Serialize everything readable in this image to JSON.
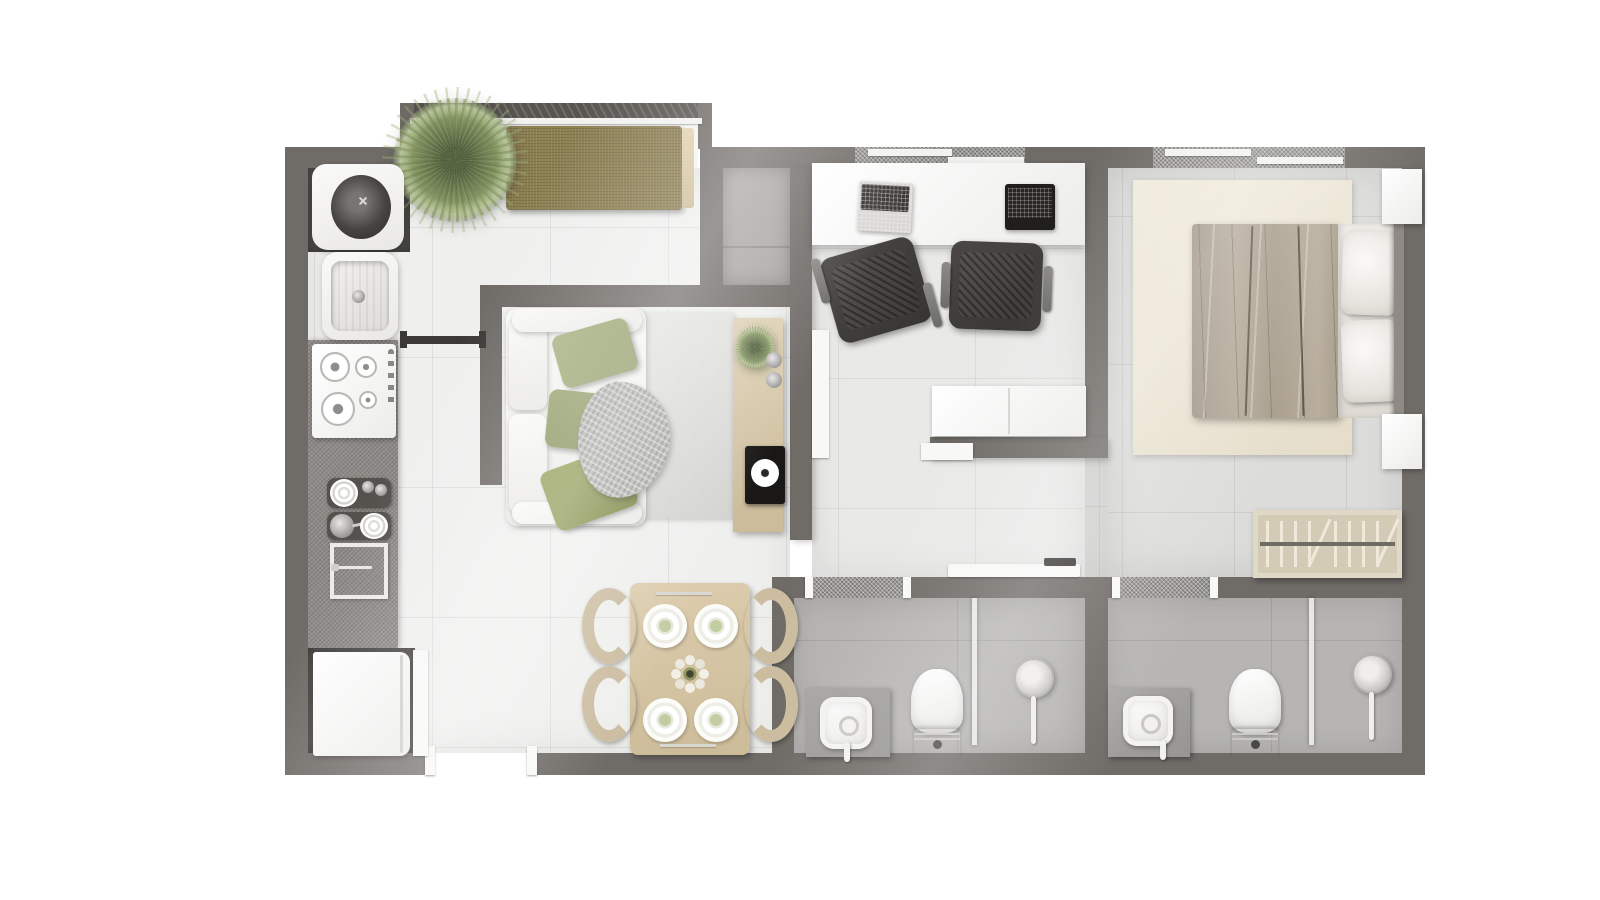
{
  "meta": {
    "title": "Apartment floor plan — top-down 3D render",
    "canvas_width": 1600,
    "canvas_height": 900,
    "visible_text": "none"
  },
  "palette": {
    "wall": "#6f6b67",
    "wall2": "#585450",
    "glassband": "#9b9995",
    "floor1": "#eff0ee",
    "floor2": "#e9eae8",
    "floor3": "#dcdcda",
    "floor4": "#b6b5b3",
    "niche": "#545150",
    "counter": "#8e8b88",
    "olive": "#8c7f51",
    "beige": "#ccbda1",
    "throw": "#b9b8b5"
  },
  "rooms": {
    "balcony": {
      "label": "Balcony bay",
      "items": {
        "bench": "Olive bench seat",
        "plant": "Large potted plant",
        "railing": "Balcony railing"
      }
    },
    "kitchen": {
      "label": "Kitchen",
      "items": {
        "washer": "Washing machine",
        "sink": "Kitchen sink",
        "cooktop": "Gas cooktop",
        "counter": "Countertop",
        "dishes": "Dish tray with plates",
        "cookware": "Pan and plates tray",
        "board": "Cutting board with knife",
        "fridge": "Refrigerator",
        "slider": "Sliding panel",
        "door": "Open door leaf"
      }
    },
    "living": {
      "label": "Living room",
      "items": {
        "sofa": "White sofa",
        "pillow": "Green cushion",
        "throw": "Gray throw blanket",
        "rug": "Area rug",
        "console": "Wood TV sideboard",
        "consolePlant": "Small plant",
        "cups": "Decorative metal objects",
        "turntable": "Record player",
        "partition": "Half-height partition wall",
        "door": "Open door leaf"
      }
    },
    "dining": {
      "label": "Dining area",
      "items": {
        "table": "Wood dining table",
        "chair": "Beige dining chair",
        "plate": "Place setting",
        "centerpiece": "Flower centerpiece",
        "cutlery": "Cutlery"
      }
    },
    "office": {
      "label": "Home office",
      "items": {
        "desk": "White desk",
        "laptopSilver": "Silver laptop",
        "laptopBlack": "Black laptop",
        "chair": "Office chair",
        "cabinet": "White sideboard cabinet",
        "window": "Window with frosted band",
        "door": "Door leaf"
      }
    },
    "bedroom": {
      "label": "Bedroom",
      "items": {
        "bed": "Double bed",
        "duvet": "Taupe duvet",
        "sheet": "Folded white sheet",
        "pillow": "Bed pillow",
        "headboard": "Headboard",
        "nightstand": "Nightstand",
        "rug": "Cream rug",
        "wardrobe": "Wardrobe with hangers",
        "window": "Window with frosted band"
      }
    },
    "bath1": {
      "label": "Bathroom 1",
      "items": {
        "vanity": "Vanity with basin",
        "toilet": "Toilet",
        "shower": "Shower head",
        "partition": "Glass shower partition",
        "window": "Frosted glass strip",
        "slidingDoor": "Sliding door"
      }
    },
    "bath2": {
      "label": "Bathroom 2",
      "items": {
        "vanity": "Vanity with basin",
        "toilet": "Toilet",
        "shower": "Shower head",
        "partition": "Glass shower partition",
        "window": "Frosted glass strip"
      }
    },
    "hall": {
      "label": "Hallway",
      "items": {
        "entry": "Entry doorway"
      }
    },
    "shaft": {
      "label": "Service shaft"
    }
  }
}
